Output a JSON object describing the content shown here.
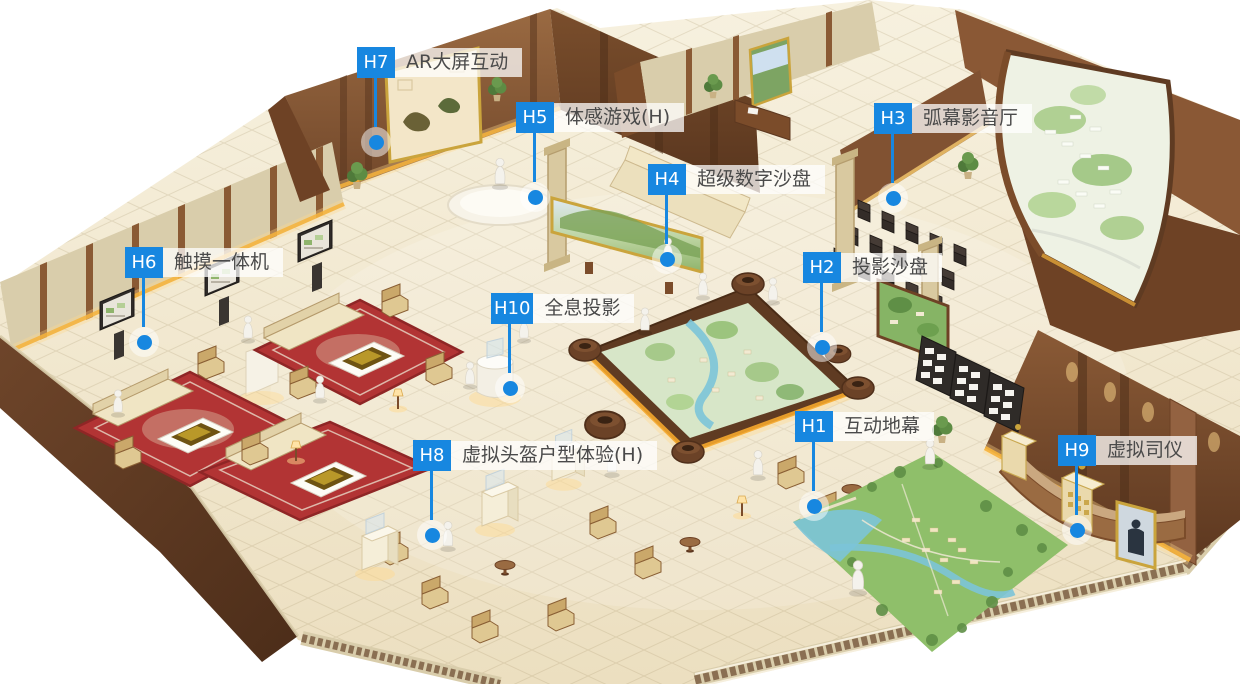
{
  "scene": {
    "description": "3D isometric rendering of a real-estate marketing exhibition hall with numbered interactive-technology hotspots",
    "accent_color": "#1787e0",
    "label_text_color": "#4a4a4a",
    "label_background": "rgba(255,255,255,0.74)",
    "floor_color": "#f1e7d0",
    "wood_color": "#7b4c2a",
    "glow_color": "#f6b33c"
  },
  "hotspots": [
    {
      "id": "H1",
      "label": "互动地幕"
    },
    {
      "id": "H2",
      "label": "投影沙盘"
    },
    {
      "id": "H3",
      "label": "弧幕影音厅"
    },
    {
      "id": "H4",
      "label": "超级数字沙盘"
    },
    {
      "id": "H5",
      "label": "体感游戏(H)"
    },
    {
      "id": "H6",
      "label": "触摸一体机"
    },
    {
      "id": "H7",
      "label": "AR大屏互动"
    },
    {
      "id": "H8",
      "label": "虚拟头盔户型体验(H)"
    },
    {
      "id": "H9",
      "label": "虚拟司仪"
    },
    {
      "id": "H10",
      "label": "全息投影"
    }
  ]
}
